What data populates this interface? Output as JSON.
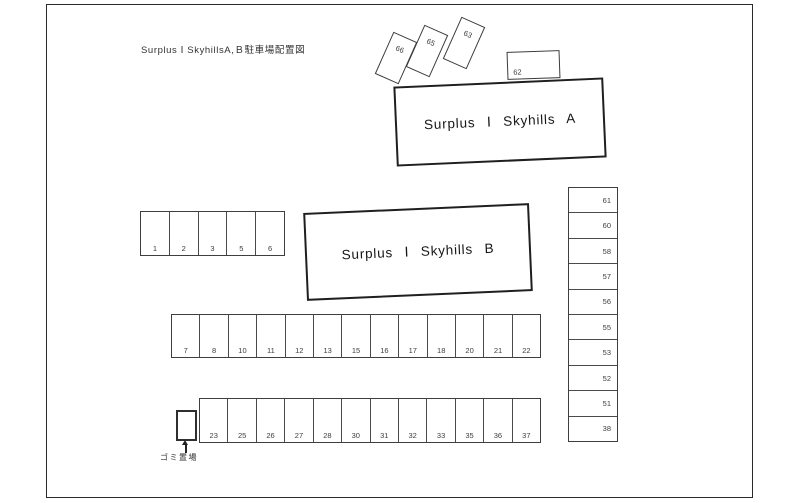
{
  "title": "Surplus Ⅰ SkyhillsA,Ｂ駐車場配置図",
  "building_a": {
    "label": "Surplus Ⅰ Skyhills A"
  },
  "building_b": {
    "label": "Surplus Ⅰ Skyhills B"
  },
  "tilted_spaces": [
    "66",
    "65",
    "63"
  ],
  "space_62": "62",
  "rows": {
    "top": [
      "1",
      "2",
      "3",
      "5",
      "6"
    ],
    "middle": [
      "7",
      "8",
      "10",
      "11",
      "12",
      "13",
      "15",
      "16",
      "17",
      "18",
      "20",
      "21",
      "22"
    ],
    "bottom": [
      "23",
      "25",
      "26",
      "27",
      "28",
      "30",
      "31",
      "32",
      "33",
      "35",
      "36",
      "37"
    ]
  },
  "right_column": [
    "61",
    "60",
    "58",
    "57",
    "56",
    "55",
    "53",
    "52",
    "51",
    "38"
  ],
  "garbage": {
    "label": "ゴミ置場"
  },
  "colors": {
    "line": "#2a2a2a",
    "cell_line": "#4a4a4a",
    "text": "#3d3d3d"
  }
}
